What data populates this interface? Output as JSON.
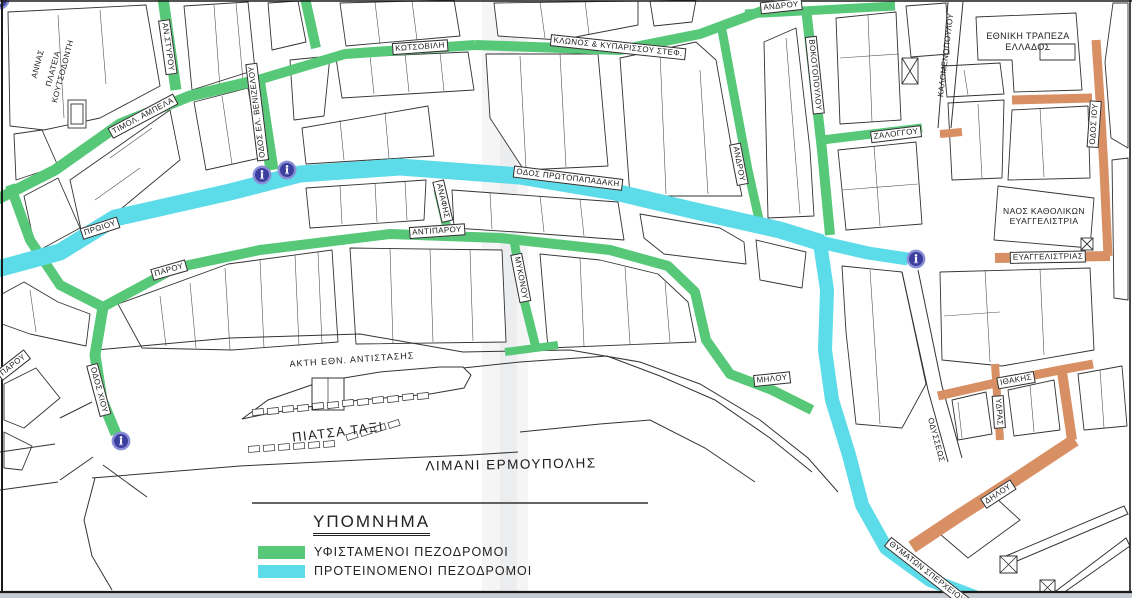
{
  "legend": {
    "title": "ΥΠΟΜΝΗΜΑ",
    "items": [
      {
        "label": "ΥΦΙΣΤΑΜΕΝΟΙ ΠΕΖΟΔΡΟΜΟΙ",
        "color": "#56c878",
        "type": "existing-pedestrian-streets"
      },
      {
        "label": "ΠΡΟΤΕΙΝΟΜΕΝΟΙ ΠΕΖΟΔΡΟΜΟΙ",
        "color": "#5cdbe8",
        "type": "proposed-pedestrian-streets"
      }
    ]
  },
  "colors": {
    "existing_green": "#56c878",
    "proposed_cyan": "#5cdbe8",
    "other_orange": "#d78f63",
    "sign_blue": "#3d3f9e",
    "sign_ring": "#8a8ed6",
    "line_dark": "#2e2e2e"
  },
  "labels": {
    "plateia_annas_l1": "ΑΝΝΑΣ",
    "plateia_annas_l2": "ΠΛΑΤΕΙΑ",
    "plateia_annas_l3": "ΚΟΥΤΣΟΔΟΝΤΗ",
    "an_styrou": "ΑΝ.ΣΤΥΡΟΥ",
    "timol_ampela": "ΤΙΜΟΛ. ΑΜΠΕΛΑ",
    "venizelou": "ΟΔΟΣ ΕΛ. ΒΕΝΙΖΕΛΟΥ",
    "kotsovili": "ΚΩΤΣΟΒΙΛΗ",
    "klonos": "ΚΛΩΝΟΣ & ΚΥΠΑΡΙΣΣΟΥ ΣΤΕΦ.",
    "androu_top": "ΑΝΔΡΟΥ",
    "androu_diag": "ΑΝΔΡΟΥ",
    "vokotopoulou": "ΒΟΚΟΤΟΠΟΥΛΟΥ",
    "zaloggou": "ΖΑΛΟΓΓΟΥ",
    "kalomenopoulou": "ΚΑΛΟΜΕΝΟΠΟΥΛΟΥ",
    "bank_l1": "ΕΘΝΙΚΗ ΤΡΑΠΕΖΑ",
    "bank_l2": "ΕΛΛΑΔΟΣ",
    "odos_iou": "ΟΔΟΣ ΙΟΥ",
    "naos_l1": "ΝΑΟΣ ΚΑΘΟΛΙΚΩΝ",
    "naos_l2": "ΕΥΑΓΓΕΛΙΣΤΡΙΑ",
    "evaggelistrias": "ΕΥΑΓΓΕΛΙΣΤΡΙΑΣ",
    "proiou": "ΠΡΩΙΟΥ",
    "parou": "ΠΑΡΟΥ",
    "parou_edge": "ΠΑΡΟΥ",
    "odos_chiou": "ΟΔΟΣ ΧΙΟΥ",
    "protopapadaki": "ΟΔΟΣ ΠΡΩΤΟΠΑΠΑΔΑΚΗ",
    "anafis": "ΑΝΑΦΗΣ",
    "antiparou": "ΑΝΤΙΠΑΡΟΥ",
    "mykonou": "ΜΥΚΟΝΟΥ",
    "milou": "ΜΗΛΟΥ",
    "akti": "ΑΚΤΗ ΕΘΝ. ΑΝΤΙΣΤΑΣΗΣ",
    "piatsa_taxi": "ΠΙΑΤΣΑ ΤΑΞΙ",
    "limani": "ΛΙΜΑΝΙ ΕΡΜΟΥΠΟΛΗΣ",
    "odysseos": "ΟΔΥΣΣΕΩΣ",
    "ithakis": "ΙΘΑΚΗΣ",
    "ydras": "ΥΔΡΑΣ",
    "dilou": "ΔΗΛΟΥ",
    "thymaton": "ΘΥΜΑΤΩΝ ΣΠΕΡΧΕΙΟΥ"
  }
}
